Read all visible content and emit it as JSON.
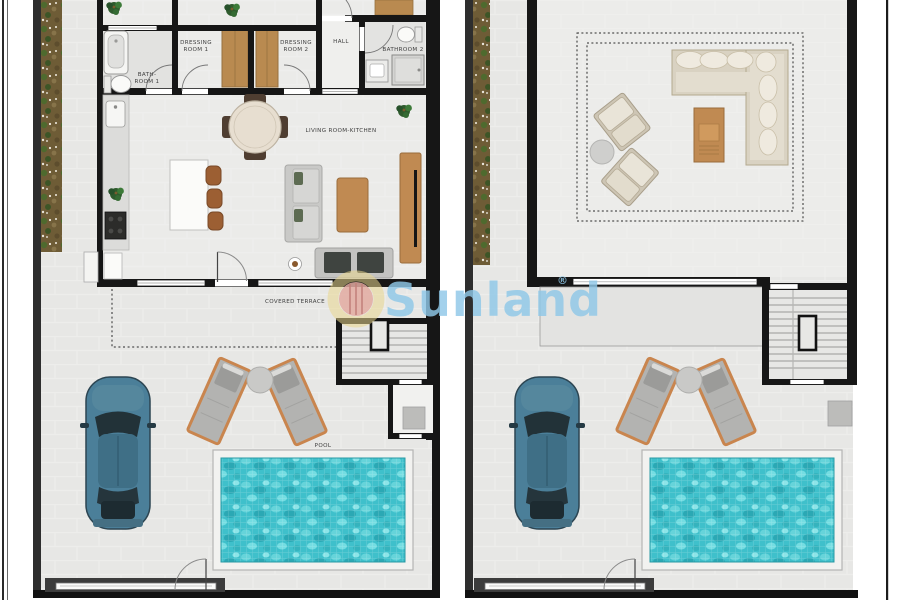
{
  "watermark": {
    "brand": "Sunland",
    "registered_mark": "®",
    "text_color": "#8fc8e8",
    "ring_color": "#e9d78e",
    "badge_color": "#e2aaa1"
  },
  "ground_floor_plan": {
    "labels": {
      "bathroom1_line1": "BATH-",
      "bathroom1_line2": "ROOM 1",
      "dressing_room1_line1": "DRESSING",
      "dressing_room1_line2": "ROOM 1",
      "dressing_room2_line1": "DRESSING",
      "dressing_room2_line2": "ROOM 2",
      "hall": "HALL",
      "bathroom2": "BATHROOM 2",
      "living_room": "LIVING ROOM-KITCHEN",
      "covered_terrace": "COVERED TERRACE",
      "pool": "POOL"
    }
  },
  "colors": {
    "wall": "#161616",
    "outdoor_floor": "#e7e7e5",
    "indoor_floor": "#ebebe9",
    "garden": "#6e5c36",
    "pool_water": "#3fc0cb",
    "pool_deck": "#f2f2f0",
    "car_body": "#4b7f99",
    "wood": "#bf8a52",
    "sofa_gray": "#c9c9c7",
    "upper_sofa_beige": "#d9d2c2",
    "lounger_frame": "#c9854e",
    "label_text": "#3f3f3f"
  }
}
